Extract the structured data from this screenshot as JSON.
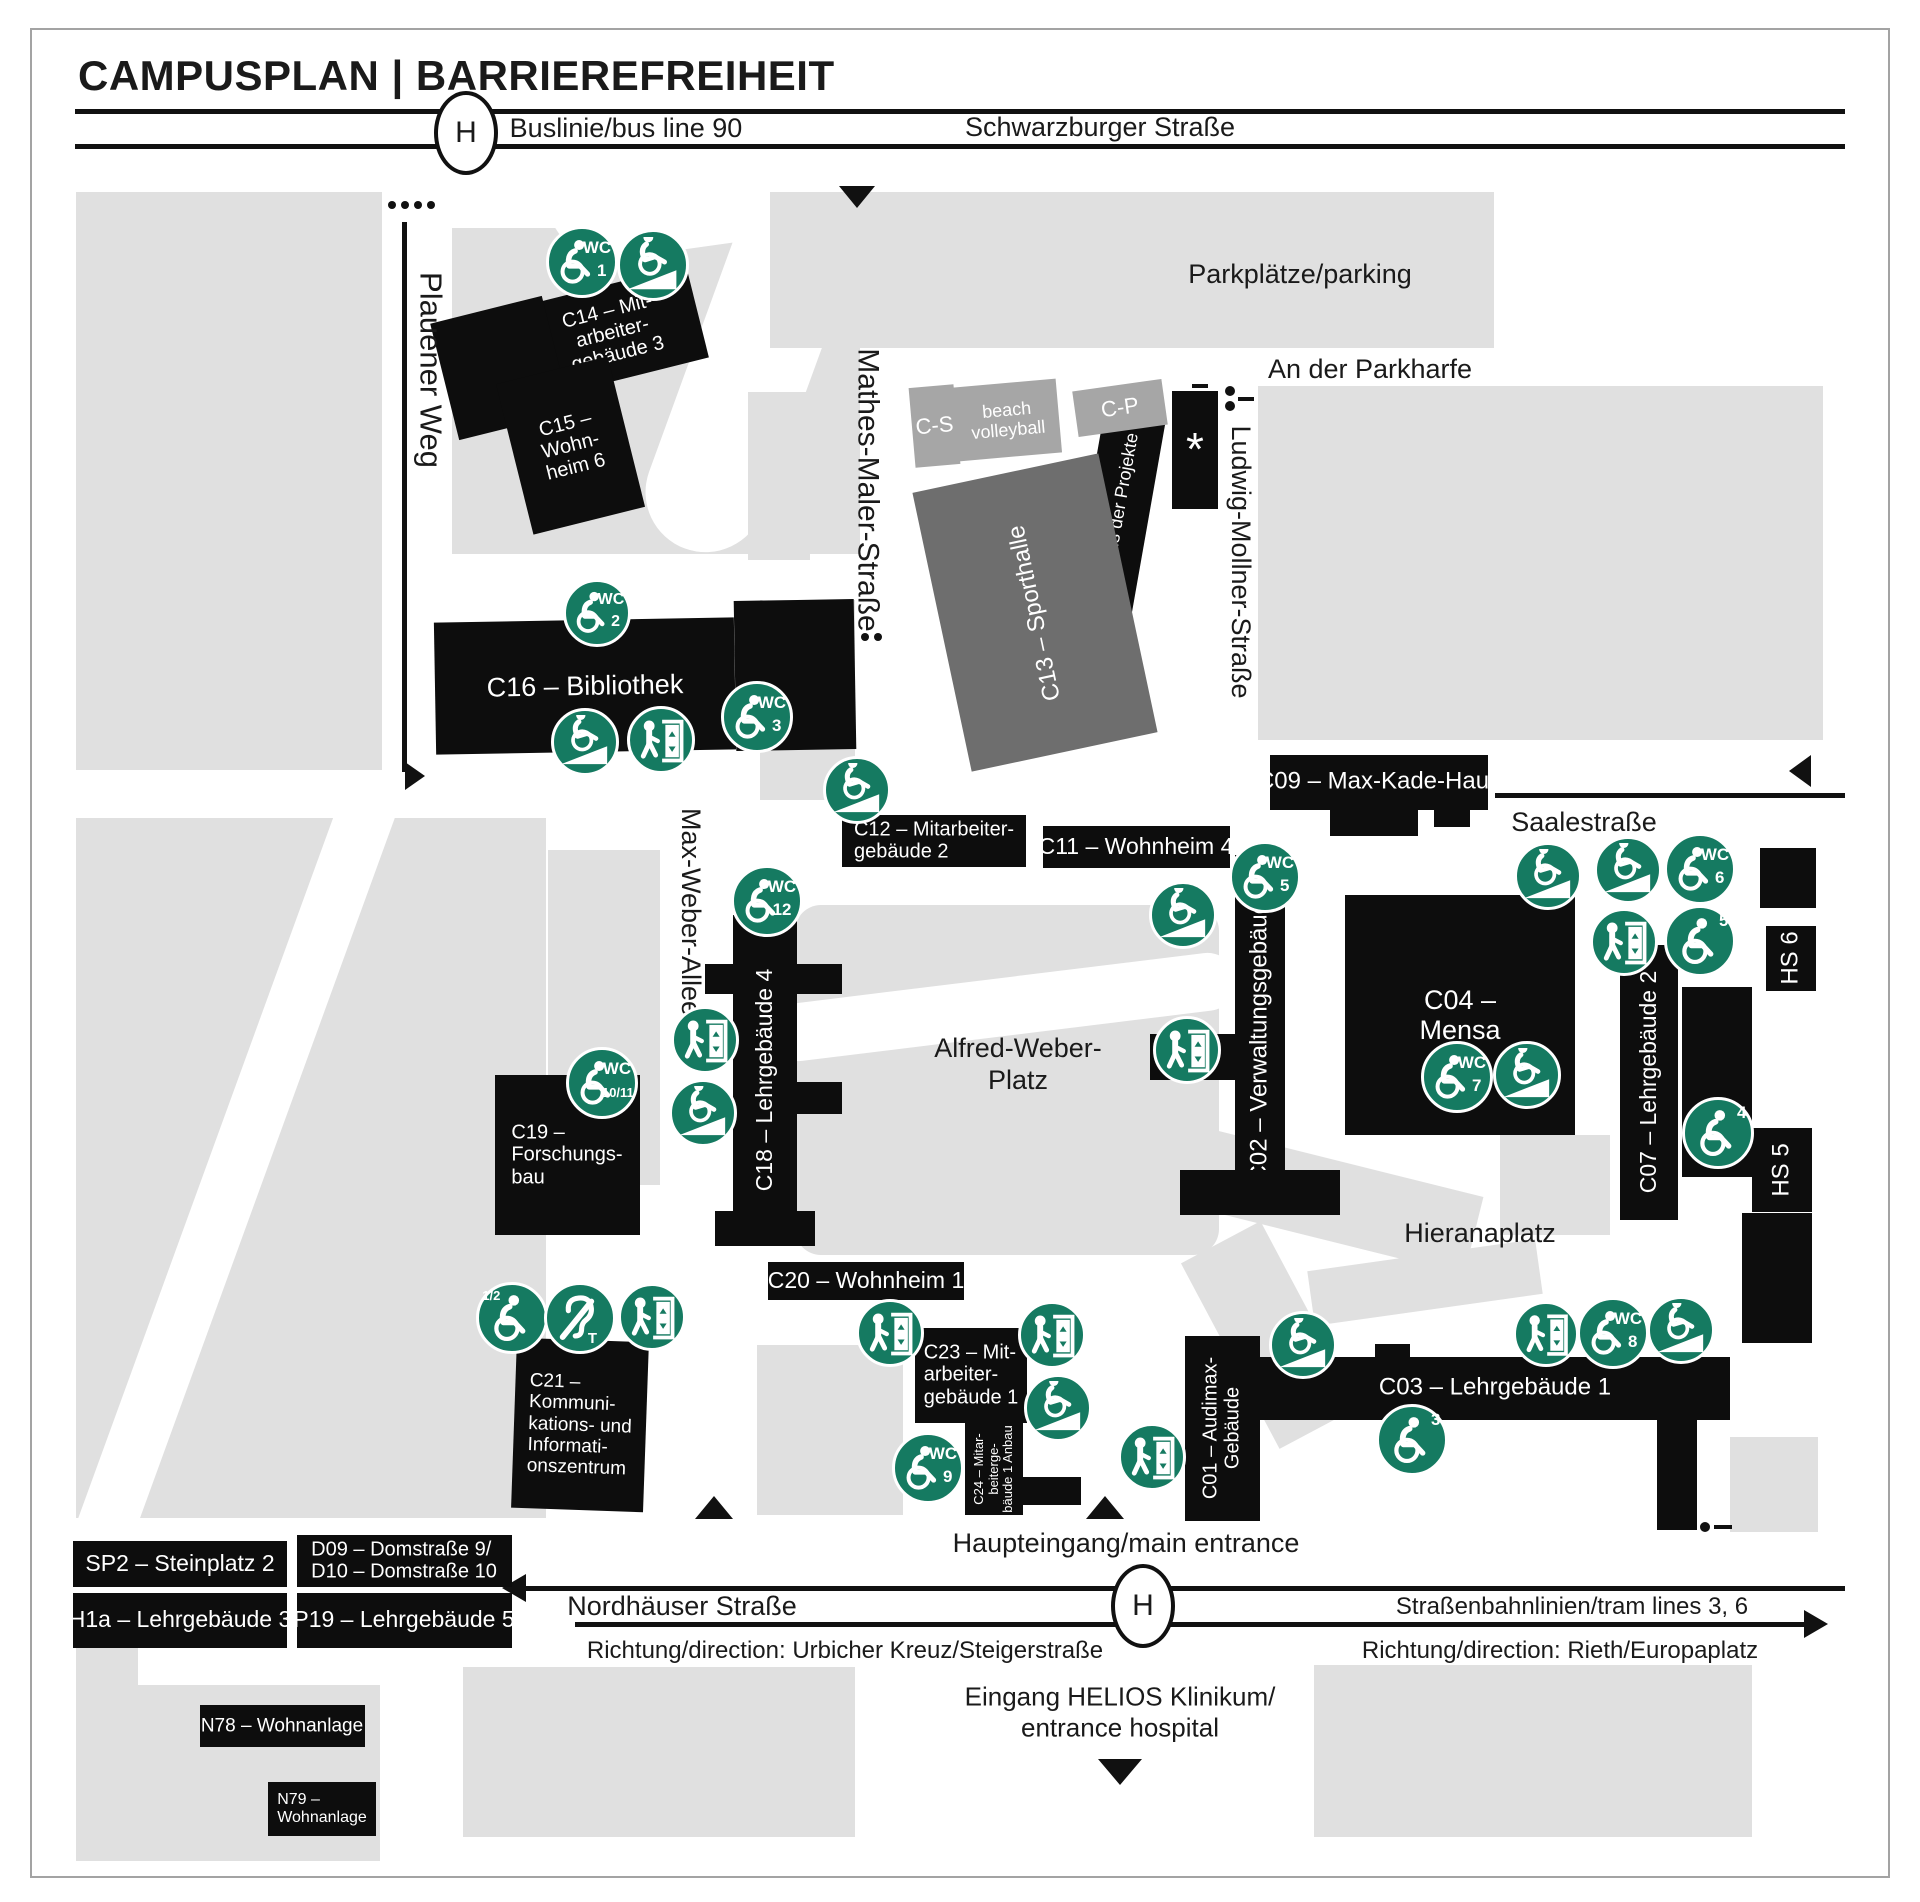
{
  "title": "CAMPUSPLAN | BARRIEREFREIHEIT",
  "colors": {
    "green": "#157a61",
    "black": "#0d0d0d",
    "dark": "#6e6e6e",
    "mid": "#a6a6a6",
    "gray_light": "#e0e0e0",
    "line": "#111111",
    "text": "#1a1a1a",
    "white": "#ffffff"
  },
  "header": {
    "bus_stop_letter": "H"
  },
  "icon_text": {
    "wc": "WC"
  },
  "icon_names": {
    "wc": "accessible-wc-icon",
    "wheel": "wheelchair-icon",
    "ramp": "ramp-icon",
    "lift": "elevator-icon",
    "ear": "hearing-loop-icon"
  },
  "areas": [
    {
      "name": "area-block-nw",
      "x": 76,
      "y": 192,
      "w": 306,
      "h": 578
    },
    {
      "name": "area-park-c15",
      "x": 452,
      "y": 228,
      "w": 408,
      "h": 326
    },
    {
      "name": "area-footpath",
      "x": 545,
      "y": 120,
      "w": 260,
      "h": 130,
      "c": "white",
      "rad": 65,
      "rot": -8
    },
    {
      "name": "area-footpath",
      "x": 690,
      "y": 180,
      "w": 120,
      "h": 380,
      "c": "white",
      "rad": 60,
      "rot": 20
    },
    {
      "name": "area-parking",
      "x": 770,
      "y": 192,
      "w": 724,
      "h": 156
    },
    {
      "name": "area-block-ne",
      "x": 1258,
      "y": 386,
      "w": 565,
      "h": 354
    },
    {
      "name": "area-strip",
      "x": 748,
      "y": 392,
      "w": 62,
      "h": 168
    },
    {
      "name": "area-strip",
      "x": 760,
      "y": 600,
      "w": 95,
      "h": 200
    },
    {
      "name": "area-alfred-weber-platz",
      "x": 795,
      "y": 905,
      "w": 424,
      "h": 350,
      "rad": 26
    },
    {
      "name": "area-footpath",
      "x": 768,
      "y": 978,
      "w": 470,
      "h": 58,
      "c": "white",
      "rad": 30,
      "rot": -7
    },
    {
      "name": "area-block-sw",
      "x": 76,
      "y": 818,
      "w": 470,
      "h": 700
    },
    {
      "name": "area-footpath",
      "x": 205,
      "y": 775,
      "w": 58,
      "h": 800,
      "c": "white",
      "rot": 20
    },
    {
      "name": "area-strip",
      "x": 548,
      "y": 850,
      "w": 112,
      "h": 335
    },
    {
      "name": "area-hieranaplatz-path",
      "x": 1060,
      "y": 1145,
      "w": 420,
      "h": 80,
      "rot": 14
    },
    {
      "name": "area-hieranaplatz-path",
      "x": 1225,
      "y": 1230,
      "w": 90,
      "h": 210,
      "rot": -28
    },
    {
      "name": "area-strip",
      "x": 1500,
      "y": 1135,
      "w": 110,
      "h": 100
    },
    {
      "name": "area-path",
      "x": 1310,
      "y": 1255,
      "w": 230,
      "h": 55,
      "rot": -8
    },
    {
      "name": "area-below-c20",
      "x": 757,
      "y": 1345,
      "w": 146,
      "h": 170
    },
    {
      "name": "area-block-s1",
      "x": 76,
      "y": 1647,
      "w": 62,
      "h": 214
    },
    {
      "name": "area-block-s2",
      "x": 138,
      "y": 1685,
      "w": 242,
      "h": 176
    },
    {
      "name": "area-block-s3",
      "x": 463,
      "y": 1667,
      "w": 392,
      "h": 170
    },
    {
      "name": "area-block-s4",
      "x": 1314,
      "y": 1665,
      "w": 438,
      "h": 172
    },
    {
      "name": "area-block-s5",
      "x": 1730,
      "y": 1437,
      "w": 88,
      "h": 95
    }
  ],
  "buildings": [
    {
      "id": "c14",
      "cx": 612,
      "cy": 332,
      "w": 175,
      "h": 95,
      "rot": -14,
      "lines": [
        "C14 – Mit-",
        "arbeiter-",
        "gebäude 3"
      ],
      "f": 20
    },
    {
      "id": "c15",
      "cx": 500,
      "cy": 368,
      "w": 115,
      "h": 120,
      "rot": -14
    },
    {
      "id": "c15",
      "cx": 570,
      "cy": 445,
      "w": 115,
      "h": 155,
      "rot": -14,
      "lines": [
        "C15 –",
        "Wohn-",
        "heim 6"
      ],
      "f": 20
    },
    {
      "id": "c16",
      "cx": 585,
      "cy": 686,
      "w": 300,
      "h": 132,
      "rot": -1,
      "lines": [
        "C16 – Bibliothek"
      ],
      "f": 27
    },
    {
      "id": "c16",
      "cx": 795,
      "cy": 675,
      "w": 120,
      "h": 150,
      "rot": -1
    },
    {
      "id": "c10",
      "cx": 1115,
      "cy": 530,
      "w": 62,
      "h": 230,
      "rot": 10,
      "lines": [
        "C10 – Haus der Projekte"
      ],
      "f": 18,
      "vert": 1
    },
    {
      "id": "star-building",
      "cx": 1195,
      "cy": 450,
      "w": 46,
      "h": 118,
      "lines": [
        "*"
      ],
      "f": 46
    },
    {
      "id": "c13",
      "cx": 1035,
      "cy": 612,
      "w": 190,
      "h": 285,
      "rot": -12,
      "c": "dark",
      "lines": [
        "C13 – Sporthalle"
      ],
      "f": 24,
      "vert": 1
    },
    {
      "id": "c-s",
      "cx": 934,
      "cy": 426,
      "w": 45,
      "h": 80,
      "rot": -5,
      "c": "mid",
      "lines": [
        "C-S"
      ],
      "f": 22
    },
    {
      "id": "beach-volleyball",
      "cx": 1007,
      "cy": 420,
      "w": 103,
      "h": 74,
      "rot": -5,
      "c": "mid",
      "lines": [
        "beach",
        "volleyball"
      ],
      "f": 18
    },
    {
      "id": "c-p",
      "cx": 1120,
      "cy": 408,
      "w": 90,
      "h": 46,
      "rot": -8,
      "c": "mid",
      "lines": [
        "C-P"
      ],
      "f": 22
    },
    {
      "id": "c12",
      "cx": 934,
      "cy": 841,
      "w": 184,
      "h": 52,
      "lines": [
        "C12 – Mitarbeiter-",
        "gebäude 2"
      ],
      "f": 20,
      "align": "l"
    },
    {
      "id": "c11",
      "cx": 1136,
      "cy": 847,
      "w": 187,
      "h": 42,
      "lines": [
        "C11 – Wohnheim 4"
      ],
      "f": 23
    },
    {
      "id": "c09",
      "cx": 1379,
      "cy": 782,
      "w": 218,
      "h": 55,
      "lines": [
        "C09 – Max-Kade-Haus"
      ],
      "f": 24
    },
    {
      "id": "c09",
      "cx": 1374,
      "cy": 822,
      "w": 88,
      "h": 28
    },
    {
      "id": "c09",
      "cx": 1452,
      "cy": 817,
      "w": 36,
      "h": 20
    },
    {
      "id": "c02",
      "cx": 1260,
      "cy": 1035,
      "w": 50,
      "h": 360,
      "lines": [
        "C02 – Verwaltungsgebäude"
      ],
      "f": 24,
      "vert": 1
    },
    {
      "id": "c02",
      "cx": 1192,
      "cy": 1057,
      "w": 85,
      "h": 46
    },
    {
      "id": "c02",
      "cx": 1260,
      "cy": 1192,
      "w": 160,
      "h": 45
    },
    {
      "id": "c04",
      "cx": 1460,
      "cy": 1015,
      "w": 230,
      "h": 240,
      "lines": [
        "C04 –",
        "Mensa"
      ],
      "f": 27
    },
    {
      "id": "hs6",
      "cx": 1788,
      "cy": 878,
      "w": 56,
      "h": 60
    },
    {
      "id": "hs6",
      "cx": 1791,
      "cy": 958,
      "w": 50,
      "h": 65,
      "lines": [
        "HS 6"
      ],
      "f": 24,
      "vert": 1
    },
    {
      "id": "c07",
      "cx": 1649,
      "cy": 1082,
      "w": 58,
      "h": 275,
      "lines": [
        "C07 – Lehrgebäude 2"
      ],
      "f": 23,
      "vert": 1
    },
    {
      "id": "c07",
      "cx": 1717,
      "cy": 1082,
      "w": 70,
      "h": 190
    },
    {
      "id": "hs5",
      "cx": 1782,
      "cy": 1170,
      "w": 60,
      "h": 84,
      "lines": [
        "HS 5"
      ],
      "f": 24,
      "vert": 1
    },
    {
      "id": "hs5",
      "cx": 1777,
      "cy": 1278,
      "w": 70,
      "h": 130
    },
    {
      "id": "c18",
      "cx": 765,
      "cy": 1080,
      "w": 64,
      "h": 330,
      "lines": [
        "C18 – Lehrgebäude 4"
      ],
      "f": 23,
      "vert": 1
    },
    {
      "id": "c18",
      "cx": 719,
      "cy": 979,
      "w": 28,
      "h": 30
    },
    {
      "id": "c18",
      "cx": 819,
      "cy": 979,
      "w": 45,
      "h": 30
    },
    {
      "id": "c18",
      "cx": 819,
      "cy": 1098,
      "w": 45,
      "h": 32
    },
    {
      "id": "c18",
      "cx": 765,
      "cy": 1228,
      "w": 100,
      "h": 35
    },
    {
      "id": "c19",
      "cx": 567,
      "cy": 1155,
      "w": 145,
      "h": 160,
      "lines": [
        "C19 –",
        "Forschungs-",
        "bau"
      ],
      "f": 20,
      "align": "l"
    },
    {
      "id": "c21",
      "cx": 580,
      "cy": 1425,
      "w": 132,
      "h": 170,
      "rot": 2,
      "lines": [
        "C21 –",
        "Kommuni-",
        "kations- und",
        "Informati-",
        "onszentrum"
      ],
      "f": 19,
      "align": "l"
    },
    {
      "id": "c20",
      "cx": 866,
      "cy": 1281,
      "w": 196,
      "h": 38,
      "lines": [
        "C20 – Wohnheim 1"
      ],
      "f": 23
    },
    {
      "id": "c23",
      "cx": 971,
      "cy": 1375,
      "w": 112,
      "h": 95,
      "lines": [
        "C23 – Mit-",
        "arbeiter-",
        "gebäude 1"
      ],
      "f": 20,
      "align": "l"
    },
    {
      "id": "c24",
      "cx": 994,
      "cy": 1469,
      "w": 58,
      "h": 92,
      "lines": [
        "C24 – Mitar-",
        "beiterge-",
        "bäude 1 Anbau"
      ],
      "f": 13,
      "vert": 1
    },
    {
      "id": "c24",
      "cx": 1052,
      "cy": 1491,
      "w": 58,
      "h": 28
    },
    {
      "id": "c01",
      "cx": 1222,
      "cy": 1428,
      "w": 75,
      "h": 185,
      "lines": [
        "C01 – Audimax-",
        "Gebäude"
      ],
      "f": 20,
      "vert": 1
    },
    {
      "id": "c03",
      "cx": 1495,
      "cy": 1388,
      "w": 470,
      "h": 63,
      "lines": [
        "C03 – Lehrgebäude 1"
      ],
      "f": 24
    },
    {
      "id": "c03",
      "cx": 1392,
      "cy": 1351,
      "w": 35,
      "h": 14
    },
    {
      "id": "c03",
      "cx": 1677,
      "cy": 1475,
      "w": 40,
      "h": 110
    },
    {
      "id": "sp2",
      "cx": 180,
      "cy": 1564,
      "w": 214,
      "h": 46,
      "lines": [
        "SP2 – Steinplatz 2"
      ],
      "f": 23,
      "align": "l"
    },
    {
      "id": "h1a",
      "cx": 180,
      "cy": 1620,
      "w": 214,
      "h": 55,
      "lines": [
        "H1a – Lehrgebäude 3"
      ],
      "f": 23,
      "align": "l"
    },
    {
      "id": "d09-d10",
      "cx": 404,
      "cy": 1561,
      "w": 215,
      "h": 52,
      "lines": [
        "D09 – Domstraße 9/",
        "D10 – Domstraße 10"
      ],
      "f": 20,
      "align": "l"
    },
    {
      "id": "p19",
      "cx": 404,
      "cy": 1620,
      "w": 215,
      "h": 55,
      "lines": [
        "P19 – Lehrgebäude 5"
      ],
      "f": 23,
      "align": "l"
    },
    {
      "id": "n78",
      "cx": 282,
      "cy": 1726,
      "w": 165,
      "h": 42,
      "lines": [
        "N78 – Wohnanlage"
      ],
      "f": 19,
      "align": "l"
    },
    {
      "id": "n79",
      "cx": 322,
      "cy": 1809,
      "w": 108,
      "h": 54,
      "lines": [
        "N79 –",
        "Wohnanlage"
      ],
      "f": 16,
      "align": "l"
    }
  ],
  "labels": [
    {
      "name": "bus-line-label",
      "cx": 626,
      "cy": 129,
      "f": 27,
      "text": "Buslinie/bus line 90"
    },
    {
      "name": "street-schwarzburger",
      "cx": 1100,
      "cy": 128,
      "f": 27,
      "text": "Schwarzburger Straße"
    },
    {
      "name": "parking-label",
      "cx": 1300,
      "cy": 275,
      "f": 27,
      "text": "Parkplätze/parking"
    },
    {
      "name": "street-an-der-parkharfe",
      "cx": 1370,
      "cy": 370,
      "f": 27,
      "text": "An der Parkharfe"
    },
    {
      "name": "street-plauener-weg",
      "cx": 430,
      "cy": 370,
      "f": 31,
      "rot": 90,
      "text": "Plauener Weg"
    },
    {
      "name": "street-mathes-maler",
      "cx": 868,
      "cy": 490,
      "f": 30,
      "rot": 90,
      "text": "Mathes-Maler-Straße"
    },
    {
      "name": "street-ludwig-mollner",
      "cx": 1240,
      "cy": 562,
      "f": 27,
      "rot": 90,
      "text": "Ludwig-Mollner-Straße"
    },
    {
      "name": "street-max-weber-allee",
      "cx": 690,
      "cy": 912,
      "f": 27,
      "rot": 90,
      "text": "Max-Weber-Allee"
    },
    {
      "name": "street-saalestrasse",
      "cx": 1584,
      "cy": 823,
      "f": 27,
      "text": "Saalestraße"
    },
    {
      "name": "alfred-weber-platz-label",
      "cx": 1018,
      "cy": 1065,
      "f": 27,
      "lines": [
        "Alfred-Weber-",
        "Platz"
      ]
    },
    {
      "name": "hieranaplatz-label",
      "cx": 1480,
      "cy": 1234,
      "f": 27,
      "text": "Hieranaplatz"
    },
    {
      "name": "main-entrance-label",
      "cx": 1126,
      "cy": 1544,
      "f": 27,
      "text": "Haupteingang/main entrance"
    },
    {
      "name": "street-nordhaeuser",
      "cx": 682,
      "cy": 1607,
      "f": 27,
      "text": "Nordhäuser Straße"
    },
    {
      "name": "direction-label-west",
      "cx": 845,
      "cy": 1651,
      "f": 24,
      "text": "Richtung/direction: Urbicher Kreuz/Steigerstraße"
    },
    {
      "name": "tram-lines-label",
      "cx": 1572,
      "cy": 1607,
      "f": 24,
      "text": "Straßenbahnlinien/tram lines 3, 6"
    },
    {
      "name": "direction-label-east",
      "cx": 1560,
      "cy": 1651,
      "f": 24,
      "text": "Richtung/direction: Rieth/Europaplatz"
    },
    {
      "name": "hospital-entrance-label",
      "cx": 1120,
      "cy": 1712,
      "f": 26,
      "lines": [
        "Eingang HELIOS Klinikum/",
        "entrance hospital"
      ]
    }
  ],
  "markers": [
    {
      "type": "wc",
      "num": "1",
      "cx": 582,
      "cy": 262,
      "r": 36
    },
    {
      "type": "ramp",
      "cx": 653,
      "cy": 265,
      "r": 36
    },
    {
      "type": "wc",
      "num": "2",
      "cx": 597,
      "cy": 613,
      "r": 34
    },
    {
      "type": "ramp",
      "cx": 585,
      "cy": 742,
      "r": 34
    },
    {
      "type": "lift",
      "cx": 661,
      "cy": 740,
      "r": 34
    },
    {
      "type": "wc",
      "num": "3",
      "cx": 757,
      "cy": 717,
      "r": 36
    },
    {
      "type": "ramp",
      "cx": 857,
      "cy": 790,
      "r": 34
    },
    {
      "type": "wc",
      "num": "12",
      "cx": 767,
      "cy": 901,
      "r": 36
    },
    {
      "type": "lift",
      "cx": 705,
      "cy": 1040,
      "r": 34
    },
    {
      "type": "ramp",
      "cx": 703,
      "cy": 1113,
      "r": 34
    },
    {
      "type": "wc",
      "num": "10/11",
      "cx": 602,
      "cy": 1083,
      "r": 36
    },
    {
      "type": "wheel",
      "num": "1/2",
      "numpos": "tl",
      "cx": 512,
      "cy": 1318,
      "r": 36
    },
    {
      "type": "ear",
      "cx": 580,
      "cy": 1318,
      "r": 36
    },
    {
      "type": "lift",
      "cx": 652,
      "cy": 1317,
      "r": 34
    },
    {
      "type": "wc",
      "num": "5",
      "cx": 1265,
      "cy": 877,
      "r": 36
    },
    {
      "type": "ramp",
      "cx": 1183,
      "cy": 915,
      "r": 34
    },
    {
      "type": "lift",
      "cx": 1187,
      "cy": 1050,
      "r": 34
    },
    {
      "type": "wc",
      "num": "7",
      "cx": 1457,
      "cy": 1077,
      "r": 36
    },
    {
      "type": "ramp",
      "cx": 1527,
      "cy": 1075,
      "r": 34
    },
    {
      "type": "ramp",
      "cx": 1548,
      "cy": 876,
      "r": 34
    },
    {
      "type": "ramp",
      "cx": 1628,
      "cy": 870,
      "r": 34
    },
    {
      "type": "wc",
      "num": "6",
      "cx": 1700,
      "cy": 869,
      "r": 36
    },
    {
      "type": "lift",
      "cx": 1624,
      "cy": 942,
      "r": 34
    },
    {
      "type": "wheel",
      "num": "5",
      "cx": 1700,
      "cy": 941,
      "r": 36
    },
    {
      "type": "wheel",
      "num": "4",
      "cx": 1718,
      "cy": 1133,
      "r": 36
    },
    {
      "type": "lift",
      "cx": 890,
      "cy": 1333,
      "r": 34
    },
    {
      "type": "lift",
      "cx": 1052,
      "cy": 1335,
      "r": 34
    },
    {
      "type": "ramp",
      "cx": 1058,
      "cy": 1408,
      "r": 34
    },
    {
      "type": "wc",
      "num": "9",
      "cx": 928,
      "cy": 1468,
      "r": 36
    },
    {
      "type": "lift",
      "cx": 1152,
      "cy": 1457,
      "r": 34
    },
    {
      "type": "ramp",
      "cx": 1303,
      "cy": 1345,
      "r": 34
    },
    {
      "type": "wheel",
      "num": "3",
      "cx": 1412,
      "cy": 1440,
      "r": 36
    },
    {
      "type": "lift",
      "cx": 1546,
      "cy": 1334,
      "r": 33
    },
    {
      "type": "wc",
      "num": "8",
      "cx": 1613,
      "cy": 1333,
      "r": 36
    },
    {
      "type": "ramp",
      "cx": 1681,
      "cy": 1330,
      "r": 34
    }
  ],
  "shapes": [
    {
      "t": "hline",
      "x": 75,
      "x2": 1845,
      "y": 111,
      "th": 5
    },
    {
      "t": "hline",
      "x": 75,
      "x2": 1845,
      "y": 146,
      "th": 5
    },
    {
      "t": "hstop",
      "cx": 462,
      "cy": 129,
      "w": 56,
      "h": 76
    },
    {
      "t": "tri",
      "d": "down",
      "cx": 857,
      "cy": 197,
      "w": 36,
      "h": 22
    },
    {
      "t": "dot",
      "cx": 392,
      "cy": 205,
      "r": 4
    },
    {
      "t": "dot",
      "cx": 405,
      "cy": 205,
      "r": 4
    },
    {
      "t": "dot",
      "cx": 418,
      "cy": 205,
      "r": 4
    },
    {
      "t": "dot",
      "cx": 431,
      "cy": 205,
      "r": 4
    },
    {
      "t": "vline",
      "x": 404,
      "y": 222,
      "y2": 772,
      "th": 5
    },
    {
      "t": "tri",
      "d": "right",
      "cx": 415,
      "cy": 776,
      "w": 20,
      "h": 28
    },
    {
      "t": "dot",
      "cx": 865,
      "cy": 637,
      "r": 4
    },
    {
      "t": "dot",
      "cx": 878,
      "cy": 637,
      "r": 4
    },
    {
      "t": "dash",
      "x": 1192,
      "y": 384,
      "w": 16,
      "h": 4
    },
    {
      "t": "dot",
      "cx": 1230,
      "cy": 391,
      "r": 5
    },
    {
      "t": "dot",
      "cx": 1230,
      "cy": 406,
      "r": 5
    },
    {
      "t": "dash",
      "x": 1238,
      "y": 397,
      "w": 16,
      "h": 4
    },
    {
      "t": "tri",
      "d": "left",
      "cx": 1800,
      "cy": 771,
      "w": 22,
      "h": 32
    },
    {
      "t": "hline",
      "x": 1495,
      "x2": 1845,
      "y": 795,
      "th": 5
    },
    {
      "t": "tri",
      "d": "up",
      "cx": 714,
      "cy": 1507,
      "w": 38,
      "h": 23
    },
    {
      "t": "tri",
      "d": "up",
      "cx": 1105,
      "cy": 1507,
      "w": 38,
      "h": 23
    },
    {
      "t": "hline",
      "x": 518,
      "x2": 1845,
      "y": 1588,
      "th": 5
    },
    {
      "t": "tri",
      "d": "left",
      "cx": 514,
      "cy": 1588,
      "w": 24,
      "h": 28
    },
    {
      "t": "hline",
      "x": 575,
      "x2": 1812,
      "y": 1624,
      "th": 5
    },
    {
      "t": "tri",
      "d": "right",
      "cx": 1816,
      "cy": 1624,
      "w": 24,
      "h": 28
    },
    {
      "t": "hstop",
      "cx": 1139,
      "cy": 1602,
      "w": 56,
      "h": 76
    },
    {
      "t": "tri",
      "d": "down",
      "cx": 1120,
      "cy": 1772,
      "w": 44,
      "h": 26
    },
    {
      "t": "dot",
      "cx": 1705,
      "cy": 1527,
      "r": 5
    },
    {
      "t": "dash",
      "x": 1714,
      "y": 1525,
      "w": 18,
      "h": 4
    }
  ]
}
